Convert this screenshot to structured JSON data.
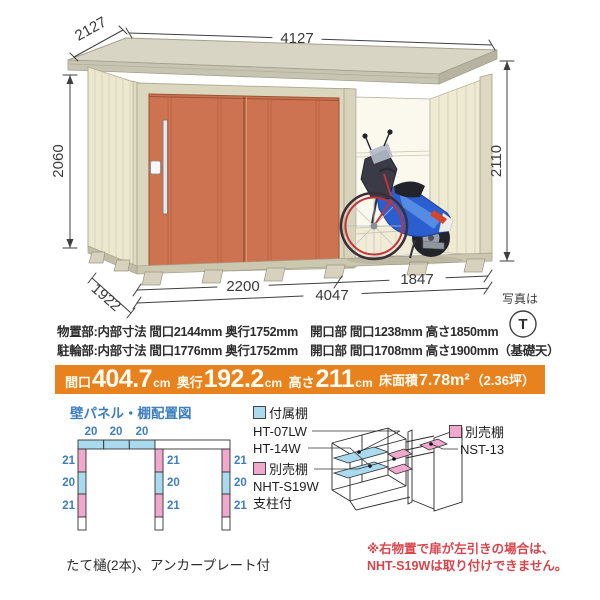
{
  "colors": {
    "door_orange": "#CE7351",
    "wall_cream": "#ECE8CF",
    "roof_gray": "#D9D5C5",
    "banner_orange": "#E8821E",
    "accent_blue": "#3D7EBF",
    "caution_red": "#D9444A",
    "shelf_blue": "#A9DAEE",
    "shelf_pink": "#F0A8CC"
  },
  "illustration": {
    "dim_depth_top": "2127",
    "dim_width_top": "4127",
    "dim_height_left": "2060",
    "dim_height_right": "2110",
    "dim_storage_front": "2200",
    "dim_total_front": "4047",
    "dim_bay_front": "1847",
    "dim_depth_bottom": "1922",
    "photo_label": "写真は",
    "photo_mark": "T"
  },
  "specs": {
    "line1": "物置部:内部寸法 間口2144mm 奥行1752mm　開口部 間口1238mm 高さ1850mm",
    "line2": "駐輪部:内部寸法 間口1776mm 奥行1752mm　開口部 間口1708mm 高さ1900mm（基礎天）"
  },
  "banner": {
    "i1": {
      "label": "間口",
      "value": "404.7",
      "unit": "cm"
    },
    "i2": {
      "label": "奥行",
      "value": "192.2",
      "unit": "cm"
    },
    "i3": {
      "label": "高さ",
      "value": "211",
      "unit": "cm"
    },
    "i4": {
      "label": "床面積",
      "value": "7.78m²",
      "unit": "（2.36坪）"
    }
  },
  "panel_layout": {
    "title": "壁パネル・棚配置図",
    "top": [
      "20",
      "20",
      "20"
    ],
    "left": [
      "21",
      "20",
      "21"
    ],
    "middle": [
      "21",
      "20",
      "21"
    ],
    "right": [
      "21",
      "20",
      "21"
    ]
  },
  "legend": {
    "attached_label": "付属棚",
    "attached_model1": "HT-07LW",
    "attached_model2": "HT-14W",
    "optional1_label": "別売棚",
    "optional1_model": "NHT-S19W",
    "optional1_note": "支柱付",
    "optional2_label": "別売棚",
    "optional2_model": "NST-13"
  },
  "notes": {
    "caution_line1": "※右物置で扉が左引きの場合は、",
    "caution_line2": "NHT-S19Wは取り付けできません。",
    "equipment": "たて樋(2本)、アンカープレート付"
  }
}
